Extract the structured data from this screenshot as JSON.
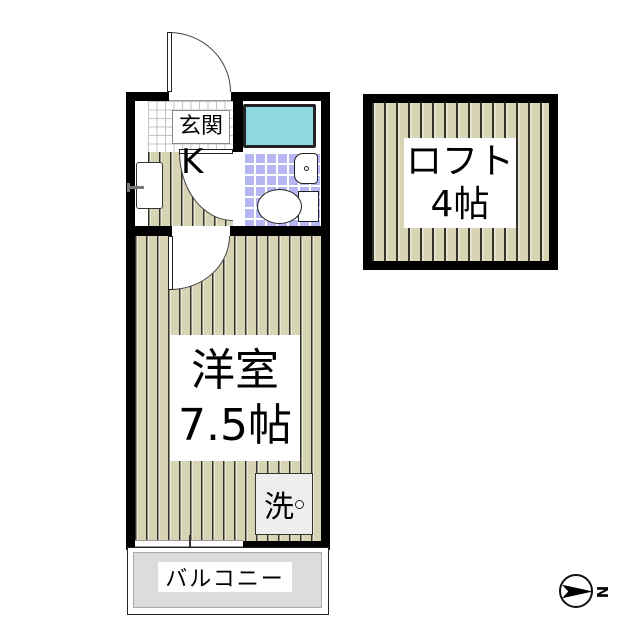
{
  "page": {
    "type": "japanese-apartment-floor-plan"
  },
  "unit": {
    "entrance": {
      "label": "玄関"
    },
    "kitchen": {
      "label": "K"
    },
    "main_room": {
      "name": "洋室",
      "size": "7.5帖"
    },
    "laundry": {
      "label": "洗"
    },
    "balcony": {
      "label": "バルコニー"
    }
  },
  "loft": {
    "name": "ロフト",
    "size": "4帖"
  },
  "compass": {
    "north_label": "N"
  },
  "colors": {
    "wall": "#000000",
    "flooring": "#d7d4b4",
    "flooring_line": "#33332a",
    "bath_tile": "#b6b6f2",
    "bathtub": "#8ed8e2",
    "balcony_fill": "#dcdcdc",
    "laundry_fill": "#ededed"
  }
}
